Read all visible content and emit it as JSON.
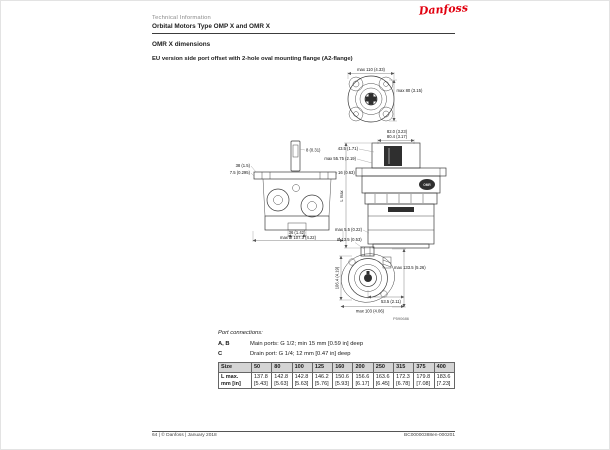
{
  "page": {
    "header": {
      "eyebrow": "Technical Information",
      "title": "Orbital Motors Type OMP X and OMR X",
      "logo_text": "Danfoss"
    },
    "section": {
      "heading": "OMR X dimensions",
      "subheading": "EU version side port offset with 2-hole oval mounting flange (A2-flange)"
    },
    "drawings": {
      "flange_view": {
        "dim_top": "max 110 (4.33)",
        "dim_right": "max 80 (3.15)"
      },
      "top_view": {
        "dim_left_1": "38 (1.5)",
        "dim_left_2": "7.5 (0.295)",
        "dim_right_1": "8 (0.31)",
        "dim_right_2": "16 (0.63)",
        "dim_bottom_1": "36 (1.42)",
        "dim_bottom_2": "max Ø 107.3 (4.22)"
      },
      "side_view": {
        "dim_top_1": "82.0 (3.23)",
        "dim_top_2": "80.4 (3.17)",
        "dim_left_1": "43.5 (1.71)",
        "dim_left_2": "max 55.75 (2.19)",
        "dim_height": "L max",
        "dim_bottom": "max 5.5 (0.22)",
        "badge": "OMR"
      },
      "end_view": {
        "dim_top": "Ø 13.5 (0.53)",
        "dim_left": "106.4 (4.19)",
        "dim_right": "max 133.5 (5.26)",
        "dim_bottom_right": "53.5 (2.11)",
        "dim_bottom": "max 103 (4.06)",
        "ref": "P590686"
      }
    },
    "ports": {
      "title": "Port connections:",
      "rows": [
        {
          "key": "A, B",
          "desc": "Main ports: G 1/2; min 15 mm [0.59 in] deep"
        },
        {
          "key": "C",
          "desc": "Drain port: G 1/4; 12 mm [0.47 in] deep"
        }
      ]
    },
    "table": {
      "header": [
        "Size",
        "50",
        "80",
        "100",
        "125",
        "160",
        "200",
        "250",
        "315",
        "375",
        "400"
      ],
      "row_label": "L max.\nmm [in]",
      "values_mm": [
        "137.8",
        "142.8",
        "142.8",
        "146.2",
        "150.6",
        "156.6",
        "163.6",
        "172.3",
        "179.8",
        "183.6"
      ],
      "values_in": [
        "[5.43]",
        "[5.63]",
        "[5.63]",
        "[5.76]",
        "[5.93]",
        "[6.17]",
        "[6.45]",
        "[6.78]",
        "[7.08]",
        "[7.23]"
      ]
    },
    "footer": {
      "left": "64 | © Danfoss | January 2018",
      "right": "BC00000388en-000201"
    }
  }
}
